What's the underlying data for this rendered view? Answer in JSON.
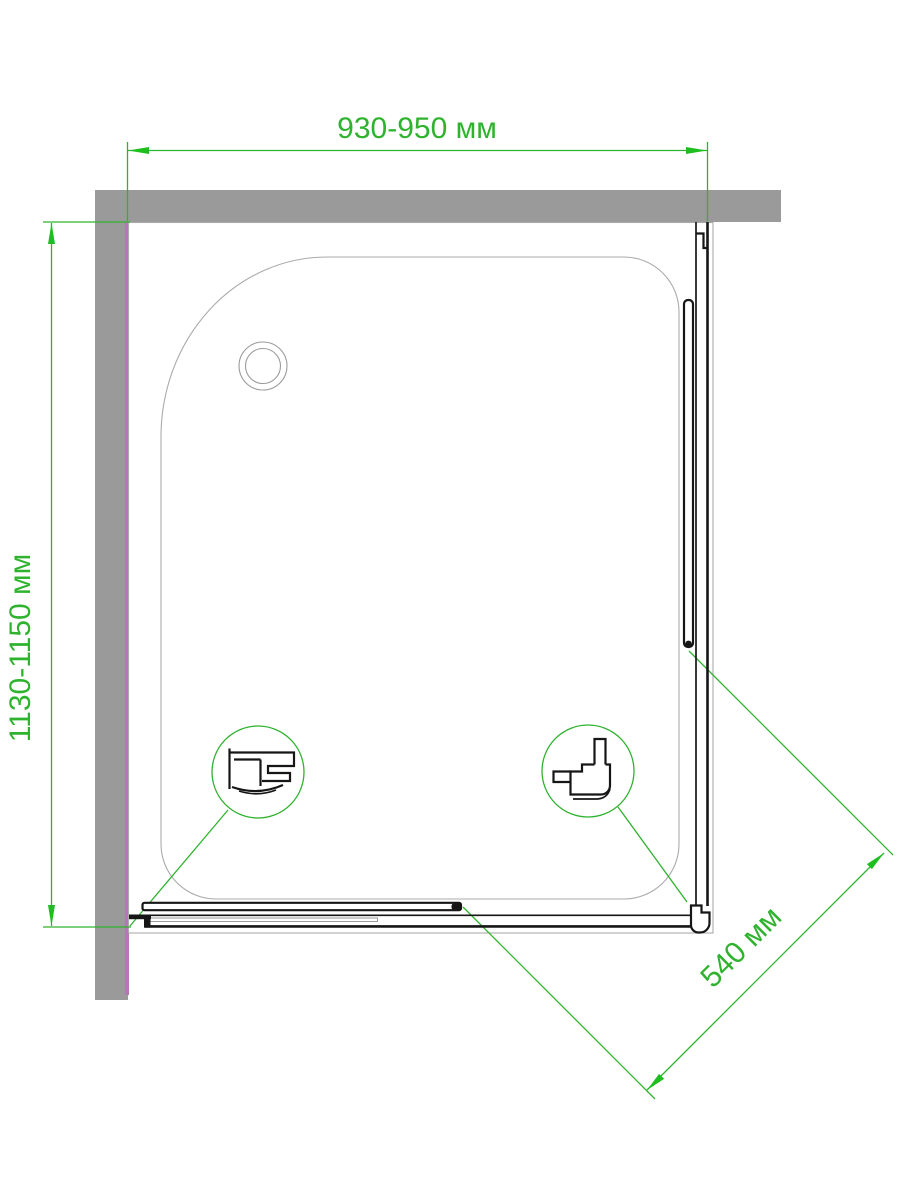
{
  "labels": {
    "width": "930-950 мм",
    "depth": "1130-1150 мм",
    "door_opening": "540 мм"
  },
  "colors": {
    "dimension": "#2fb32f",
    "arrow": "#1dbe1d",
    "wall": "#9a9a9a",
    "wall_accent": "#b377b3",
    "ink": "#161616",
    "tray_outline": "#ababab"
  }
}
